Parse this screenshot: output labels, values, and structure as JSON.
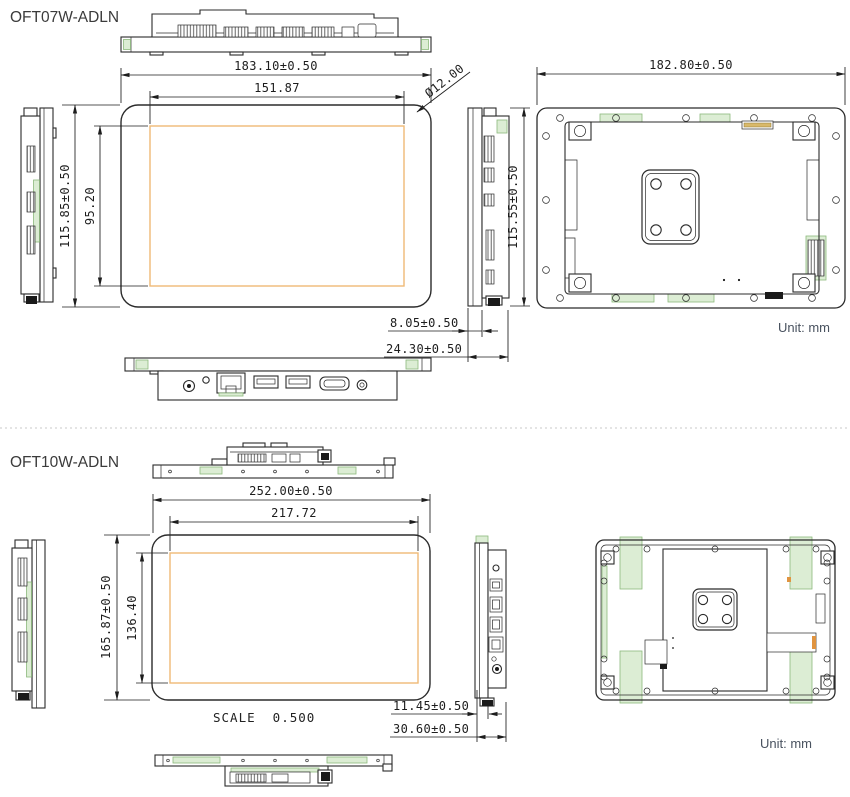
{
  "colors": {
    "line": "#2b2b2b",
    "active_area_orange": "#efba76",
    "highlight_green": "#dcedd4",
    "unit_text": "#49525f",
    "background": "#ffffff"
  },
  "sections": [
    {
      "id": "oft07w",
      "title": "OFT07W-ADLN",
      "unit_label": "Unit: mm",
      "dimensions": {
        "outer_width": "183.10±0.50",
        "active_width": "151.87",
        "outer_height": "115.85±0.50",
        "active_height": "95.20",
        "rear_width": "182.80±0.50",
        "side_height": "115.55±0.50",
        "corner_radius": "Ø12.00",
        "depth_front": "8.05±0.50",
        "depth_total": "24.30±0.50"
      }
    },
    {
      "id": "oft10w",
      "title": "OFT10W-ADLN",
      "unit_label": "Unit: mm",
      "scale_label": "SCALE  0.500",
      "dimensions": {
        "outer_width": "252.00±0.50",
        "active_width": "217.72",
        "outer_height": "165.87±0.50",
        "active_height": "136.40",
        "depth_front": "11.45±0.50",
        "depth_total": "30.60±0.50"
      }
    }
  ]
}
